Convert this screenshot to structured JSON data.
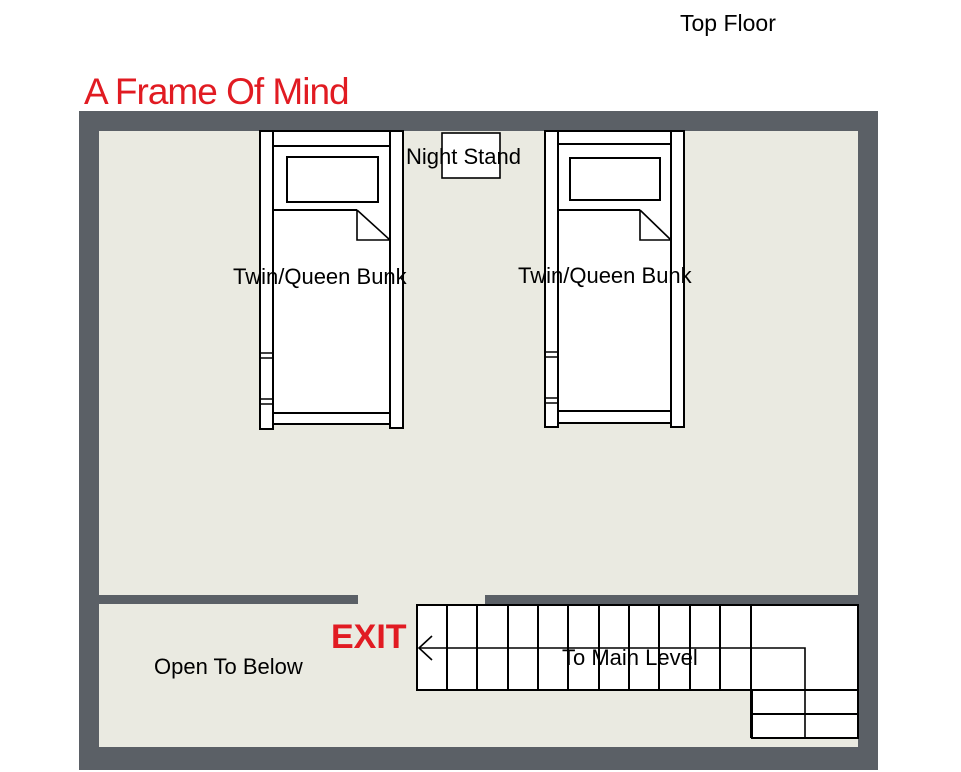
{
  "page": {
    "corner_label": "Top Floor"
  },
  "plan": {
    "title": "A Frame Of Mind",
    "labels": {
      "night_stand": "Night Stand",
      "bunk_left": "Twin/Queen Bunk",
      "bunk_right": "Twin/Queen Bunk",
      "exit": "EXIT",
      "open_to_below": "Open To Below",
      "to_main_level": "To Main Level"
    }
  },
  "colors": {
    "wall": "#5b6066",
    "floor": "#eaeae1",
    "red": "#e11b22",
    "line": "#000000",
    "fixture": "#ffffff"
  }
}
